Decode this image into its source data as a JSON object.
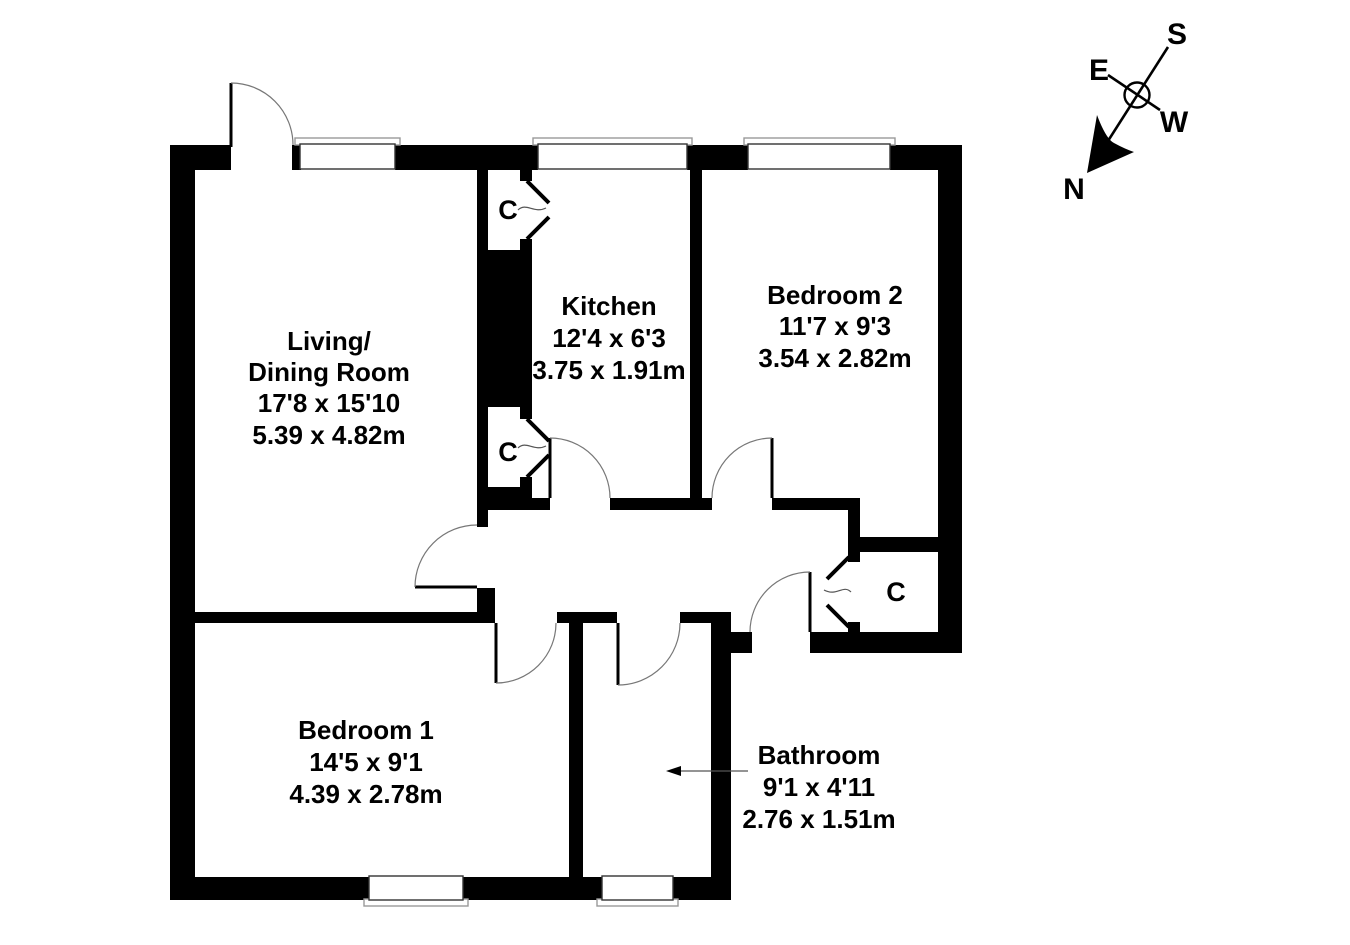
{
  "floorplan": {
    "rooms": {
      "living": {
        "lines": [
          "Living/",
          "Dining Room",
          "17'8 x 15'10",
          "5.39 x 4.82m"
        ]
      },
      "kitchen": {
        "lines": [
          "Kitchen",
          "12'4 x 6'3",
          "3.75 x 1.91m"
        ]
      },
      "bedroom2": {
        "lines": [
          "Bedroom 2",
          "11'7 x 9'3",
          "3.54 x 2.82m"
        ]
      },
      "bedroom1": {
        "lines": [
          "Bedroom 1",
          "14'5 x 9'1",
          "4.39 x 2.78m"
        ]
      },
      "bathroom": {
        "lines": [
          "Bathroom",
          "9'1 x 4'11",
          "2.76 x 1.51m"
        ]
      }
    },
    "closet_label": "C",
    "compass": {
      "north": "N",
      "south": "S",
      "east": "E",
      "west": "W"
    },
    "colors": {
      "wall": "#000000",
      "arc_line": "#777777",
      "sill_line": "#999999",
      "background": "#ffffff"
    }
  }
}
